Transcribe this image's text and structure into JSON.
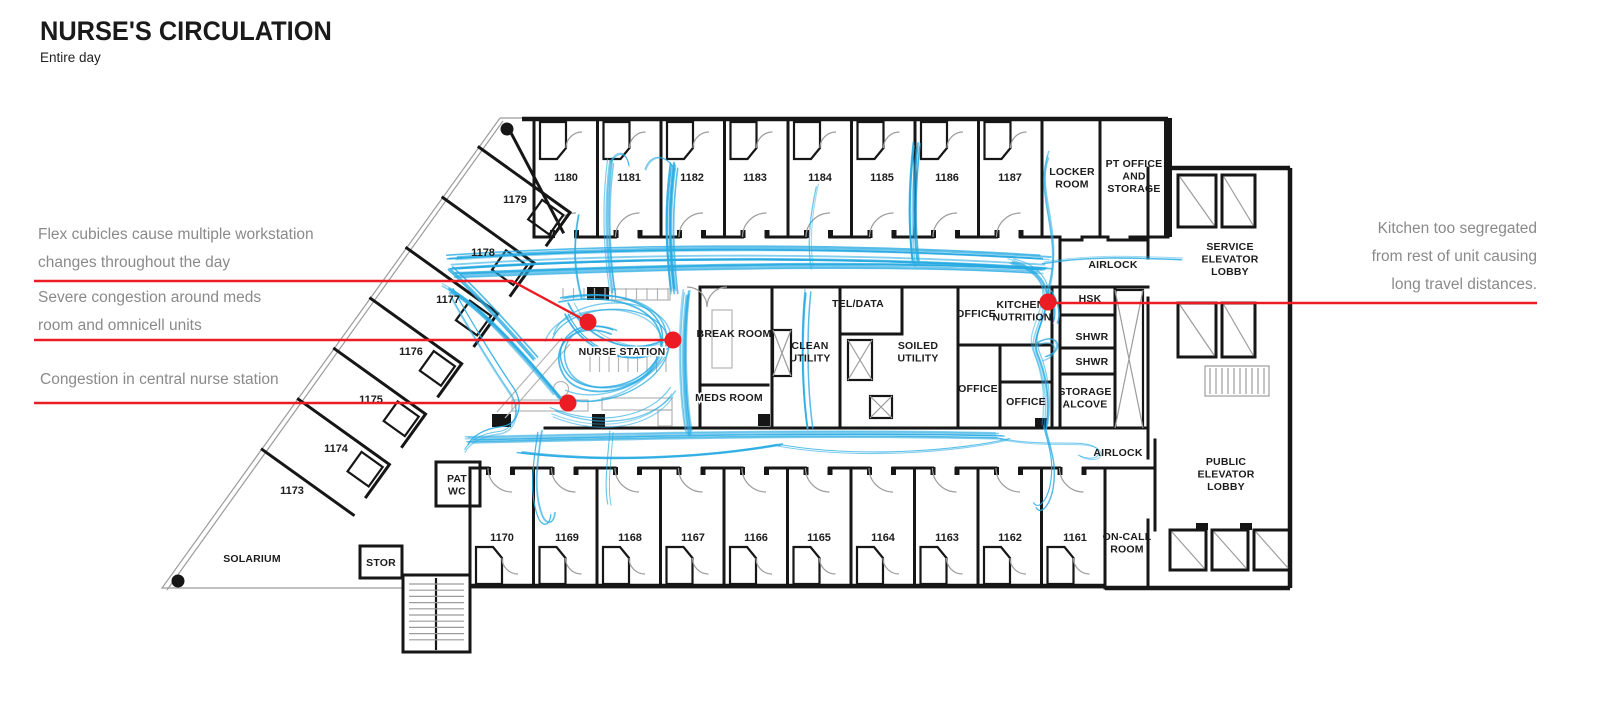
{
  "page": {
    "title": "NURSE'S CIRCULATION",
    "subtitle": "Entire day"
  },
  "colors": {
    "circulation": "#29ABE2",
    "annotation": "#EC1C24",
    "wall": "#161616",
    "thin_line": "#9c9c9c",
    "furniture": "#b5b5b5",
    "annotation_text": "#8a8a8a",
    "background": "#ffffff"
  },
  "annotations": {
    "left": [
      {
        "name": "flex-cubicles-note",
        "lines": [
          "Flex cubicles cause multiple workstation",
          "changes throughout the day"
        ],
        "x": 38,
        "y": 221,
        "leader": [
          [
            34,
            281
          ],
          [
            512,
            281
          ],
          [
            588,
            322
          ]
        ],
        "dot": [
          588,
          322
        ]
      },
      {
        "name": "meds-congestion-note",
        "lines": [
          "Severe congestion around meds",
          "room and omnicell units"
        ],
        "x": 38,
        "y": 284,
        "leader": [
          [
            34,
            340
          ],
          [
            673,
            340
          ]
        ],
        "dot": [
          673,
          340
        ]
      },
      {
        "name": "nurse-station-congestion-note",
        "lines": [
          "Congestion in central nurse station"
        ],
        "x": 40,
        "y": 366,
        "leader": [
          [
            34,
            403
          ],
          [
            568,
            403
          ]
        ],
        "dot": [
          568,
          403
        ]
      }
    ],
    "right": [
      {
        "name": "kitchen-segregated-note",
        "lines": [
          "Kitchen too segregated",
          "from rest of unit causing",
          "long travel distances."
        ],
        "x": 1537,
        "y": 215,
        "align": "right",
        "leader": [
          [
            1048,
            303
          ],
          [
            1537,
            303
          ]
        ],
        "dot": [
          1048,
          302
        ]
      }
    ]
  },
  "floorplan": {
    "labels": [
      {
        "name": "room-1180",
        "cls": "num",
        "x": 566,
        "y": 181,
        "lines": [
          "1180"
        ]
      },
      {
        "name": "room-1181",
        "cls": "num",
        "x": 629,
        "y": 181,
        "lines": [
          "1181"
        ]
      },
      {
        "name": "room-1182",
        "cls": "num",
        "x": 692,
        "y": 181,
        "lines": [
          "1182"
        ]
      },
      {
        "name": "room-1183",
        "cls": "num",
        "x": 755,
        "y": 181,
        "lines": [
          "1183"
        ]
      },
      {
        "name": "room-1184",
        "cls": "num",
        "x": 820,
        "y": 181,
        "lines": [
          "1184"
        ]
      },
      {
        "name": "room-1185",
        "cls": "num",
        "x": 882,
        "y": 181,
        "lines": [
          "1185"
        ]
      },
      {
        "name": "room-1186",
        "cls": "num",
        "x": 947,
        "y": 181,
        "lines": [
          "1186"
        ]
      },
      {
        "name": "room-1187",
        "cls": "num",
        "x": 1010,
        "y": 181,
        "lines": [
          "1187"
        ]
      },
      {
        "name": "room-1170",
        "cls": "num",
        "x": 502,
        "y": 541,
        "lines": [
          "1170"
        ]
      },
      {
        "name": "room-1169",
        "cls": "num",
        "x": 567,
        "y": 541,
        "lines": [
          "1169"
        ]
      },
      {
        "name": "room-1168",
        "cls": "num",
        "x": 630,
        "y": 541,
        "lines": [
          "1168"
        ]
      },
      {
        "name": "room-1167",
        "cls": "num",
        "x": 693,
        "y": 541,
        "lines": [
          "1167"
        ]
      },
      {
        "name": "room-1166",
        "cls": "num",
        "x": 756,
        "y": 541,
        "lines": [
          "1166"
        ]
      },
      {
        "name": "room-1165",
        "cls": "num",
        "x": 819,
        "y": 541,
        "lines": [
          "1165"
        ]
      },
      {
        "name": "room-1164",
        "cls": "num",
        "x": 883,
        "y": 541,
        "lines": [
          "1164"
        ]
      },
      {
        "name": "room-1163",
        "cls": "num",
        "x": 947,
        "y": 541,
        "lines": [
          "1163"
        ]
      },
      {
        "name": "room-1162",
        "cls": "num",
        "x": 1010,
        "y": 541,
        "lines": [
          "1162"
        ]
      },
      {
        "name": "room-1161",
        "cls": "num",
        "x": 1075,
        "y": 541,
        "lines": [
          "1161"
        ]
      },
      {
        "name": "room-1179",
        "cls": "num",
        "x": 515,
        "y": 203,
        "lines": [
          "1179"
        ]
      },
      {
        "name": "room-1178",
        "cls": "num",
        "x": 483,
        "y": 256,
        "lines": [
          "1178"
        ]
      },
      {
        "name": "room-1177",
        "cls": "num",
        "x": 448,
        "y": 303,
        "lines": [
          "1177"
        ]
      },
      {
        "name": "room-1176",
        "cls": "num",
        "x": 411,
        "y": 355,
        "lines": [
          "1176"
        ]
      },
      {
        "name": "room-1175",
        "cls": "num",
        "x": 371,
        "y": 403,
        "lines": [
          "1175"
        ]
      },
      {
        "name": "room-1174",
        "cls": "num",
        "x": 336,
        "y": 452,
        "lines": [
          "1174"
        ]
      },
      {
        "name": "room-1173",
        "cls": "num",
        "x": 292,
        "y": 494,
        "lines": [
          "1173"
        ]
      },
      {
        "name": "locker-room",
        "cls": "area",
        "x": 1072,
        "y": 175,
        "lines": [
          "LOCKER",
          "ROOM"
        ]
      },
      {
        "name": "pt-office-storage",
        "cls": "area",
        "x": 1134,
        "y": 167,
        "lines": [
          "PT OFFICE",
          "AND",
          "STORAGE"
        ]
      },
      {
        "name": "service-elevator-lobby",
        "cls": "area",
        "x": 1230,
        "y": 250,
        "lines": [
          "SERVICE",
          "ELEVATOR",
          "LOBBY"
        ]
      },
      {
        "name": "airlock-top",
        "cls": "area",
        "x": 1113,
        "y": 268,
        "lines": [
          "AIRLOCK"
        ]
      },
      {
        "name": "hsk",
        "cls": "area",
        "x": 1090,
        "y": 302,
        "lines": [
          "HSK"
        ]
      },
      {
        "name": "shwr-1",
        "cls": "area",
        "x": 1092,
        "y": 340,
        "lines": [
          "SHWR"
        ]
      },
      {
        "name": "shwr-2",
        "cls": "area",
        "x": 1092,
        "y": 365,
        "lines": [
          "SHWR"
        ]
      },
      {
        "name": "kitchen-nutrition",
        "cls": "area",
        "x": 1022,
        "y": 308,
        "lines": [
          "KITCHEN/",
          "NUTRITION"
        ]
      },
      {
        "name": "office-top",
        "cls": "area",
        "x": 976,
        "y": 317,
        "lines": [
          "OFFICE"
        ]
      },
      {
        "name": "soiled-utility",
        "cls": "area",
        "x": 918,
        "y": 349,
        "lines": [
          "SOILED",
          "UTILITY"
        ]
      },
      {
        "name": "tel-data",
        "cls": "area",
        "x": 858,
        "y": 307,
        "lines": [
          "TEL/DATA"
        ]
      },
      {
        "name": "clean-utility",
        "cls": "area",
        "x": 810,
        "y": 349,
        "lines": [
          "CLEAN",
          "UTILITY"
        ]
      },
      {
        "name": "break-room",
        "cls": "area",
        "x": 734,
        "y": 337,
        "lines": [
          "BREAK ROOM"
        ]
      },
      {
        "name": "nurse-station",
        "cls": "area halo",
        "x": 622,
        "y": 355,
        "lines": [
          "NURSE STATION"
        ]
      },
      {
        "name": "meds-room",
        "cls": "area halo",
        "x": 729,
        "y": 401,
        "lines": [
          "MEDS ROOM"
        ]
      },
      {
        "name": "office-bottom-left",
        "cls": "area",
        "x": 978,
        "y": 392,
        "lines": [
          "OFFICE"
        ]
      },
      {
        "name": "office-bottom-right",
        "cls": "area",
        "x": 1026,
        "y": 405,
        "lines": [
          "OFFICE"
        ]
      },
      {
        "name": "storage-alcove",
        "cls": "area",
        "x": 1085,
        "y": 395,
        "lines": [
          "STORAGE",
          "ALCOVE"
        ]
      },
      {
        "name": "airlock-bottom",
        "cls": "area",
        "x": 1118,
        "y": 456,
        "lines": [
          "AIRLOCK"
        ]
      },
      {
        "name": "public-elevator-lobby",
        "cls": "area",
        "x": 1226,
        "y": 465,
        "lines": [
          "PUBLIC",
          "ELEVATOR",
          "LOBBY"
        ]
      },
      {
        "name": "on-call-room",
        "cls": "area",
        "x": 1127,
        "y": 540,
        "lines": [
          "ON-CALL",
          "ROOM"
        ]
      },
      {
        "name": "pat-wc",
        "cls": "area",
        "x": 457,
        "y": 482,
        "lines": [
          "PAT",
          "WC"
        ]
      },
      {
        "name": "stor",
        "cls": "area",
        "x": 381,
        "y": 566,
        "lines": [
          "STOR"
        ]
      },
      {
        "name": "solarium",
        "cls": "area",
        "x": 252,
        "y": 562,
        "lines": [
          "SOLARIUM"
        ]
      }
    ]
  },
  "circulation": {
    "paths": [
      {
        "d": "M452,262 C600,252 820,248 1045,262",
        "n": 12,
        "j": 7,
        "w": 1.4
      },
      {
        "d": "M458,276 C650,268 880,262 1040,272",
        "n": 7,
        "j": 5,
        "w": 1.3
      },
      {
        "d": "M470,440 C640,436 830,432 1000,436",
        "n": 8,
        "j": 5,
        "w": 1.3
      },
      {
        "d": "M520,452 C600,462 700,458 780,444",
        "n": 3,
        "j": 3,
        "w": 1.2
      },
      {
        "d": "M780,446 C860,460 960,452 1010,440",
        "n": 2,
        "j": 3,
        "w": 1.2
      },
      {
        "d": "M674,165 C668,210 669,245 674,290",
        "n": 11,
        "j": 4,
        "w": 1.4
      },
      {
        "d": "M674,168 C666,152 650,152 645,168",
        "n": 2,
        "j": 2,
        "w": 1.2
      },
      {
        "d": "M611,160 C605,205 607,250 613,292",
        "n": 5,
        "j": 4,
        "w": 1.3
      },
      {
        "d": "M611,163 C617,150 627,152 629,166",
        "n": 2,
        "j": 2,
        "w": 1.2
      },
      {
        "d": "M577,215 C571,248 573,272 580,298",
        "n": 2,
        "j": 2,
        "w": 1.2
      },
      {
        "d": "M818,186 C811,218 809,246 813,268",
        "n": 2,
        "j": 2,
        "w": 1.2
      },
      {
        "d": "M917,145 C912,190 912,230 916,262",
        "n": 8,
        "j": 4,
        "w": 1.4
      },
      {
        "d": "M1050,155 C1036,195 1066,235 1050,290",
        "n": 3,
        "j": 4,
        "w": 1.2
      },
      {
        "d": "M686,292 C681,330 681,390 688,432",
        "n": 8,
        "j": 4,
        "w": 1.4
      },
      {
        "d": "M808,292 C804,330 804,385 810,428",
        "n": 5,
        "j": 3,
        "w": 1.2
      },
      {
        "d": "M560,300 C625,288 672,312 660,352 C648,392 580,402 564,372 C549,344 576,318 612,332",
        "n": 4,
        "j": 7,
        "w": 1.3
      },
      {
        "d": "M552,412 C600,432 652,422 672,392",
        "n": 4,
        "j": 6,
        "w": 1.3
      },
      {
        "d": "M568,308 C588,350 640,362 668,342",
        "n": 4,
        "j": 7,
        "w": 1.3
      },
      {
        "d": "M548,340 C560,302 650,296 664,336 C674,376 602,414 560,396",
        "n": 3,
        "j": 6,
        "w": 1.3
      },
      {
        "d": "M447,288 C476,302 520,350 558,396",
        "n": 7,
        "j": 5,
        "w": 1.4
      },
      {
        "d": "M450,270 C468,286 500,320 535,360",
        "n": 4,
        "j": 4,
        "w": 1.3
      },
      {
        "d": "M449,292 C462,316 488,360 510,392 C520,407 515,428 498,430 C480,432 468,440 464,448",
        "n": 3,
        "j": 4,
        "w": 1.2
      },
      {
        "d": "M540,430 C534,468 532,492 540,514 C544,525 552,524 553,512",
        "n": 3,
        "j": 3,
        "w": 1.2
      },
      {
        "d": "M612,432 C610,460 606,486 610,505",
        "n": 2,
        "j": 3,
        "w": 1.1
      },
      {
        "d": "M1012,262 C1038,268 1050,286 1046,304 C1042,326 1030,338 1038,356 C1046,376 1050,400 1046,428",
        "n": 6,
        "j": 4,
        "w": 1.4
      },
      {
        "d": "M1036,344 C1056,332 1064,352 1044,358",
        "n": 3,
        "j": 3,
        "w": 1.1
      },
      {
        "d": "M1046,428 C1050,446 1058,462 1052,490 C1048,505 1040,512 1036,505",
        "n": 2,
        "j": 3,
        "w": 1.1
      },
      {
        "d": "M1000,438 C1050,448 1086,438 1098,448 C1106,456 1094,462 1080,455",
        "n": 2,
        "j": 3,
        "w": 1.1
      },
      {
        "d": "M1043,262 C1090,254 1130,256 1182,258",
        "n": 2,
        "j": 2,
        "w": 1.1
      },
      {
        "d": "M1050,290 C1056,300 1060,312 1056,322",
        "n": 3,
        "j": 3,
        "w": 1.2
      }
    ]
  }
}
